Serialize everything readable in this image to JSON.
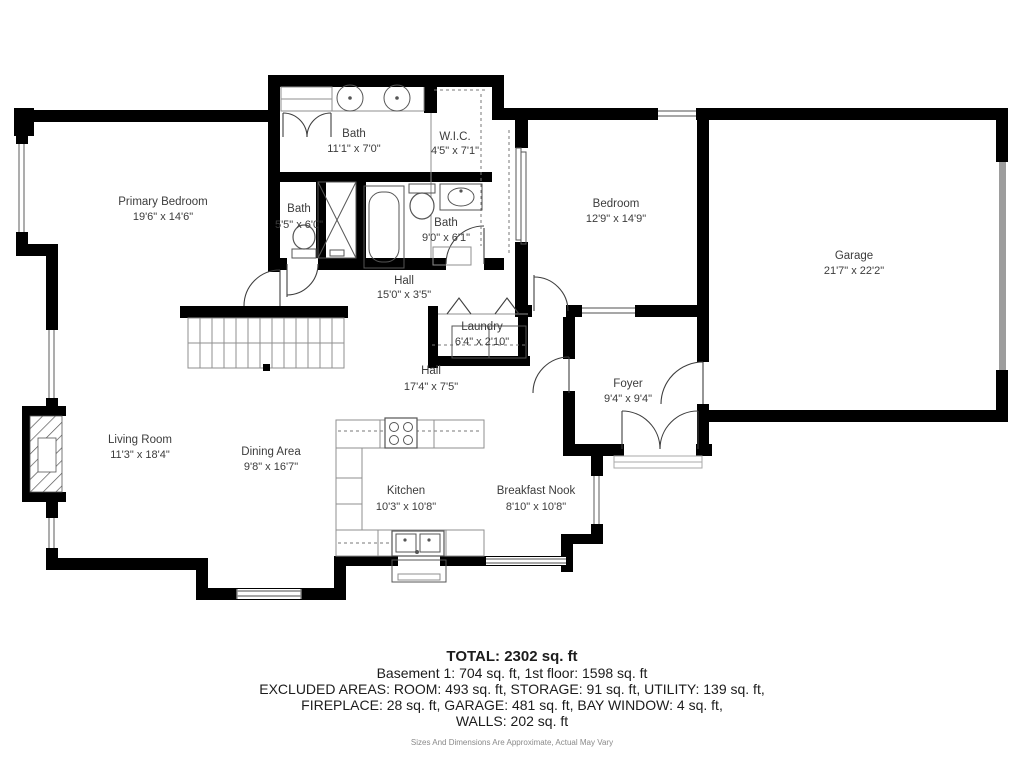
{
  "rooms": {
    "primary_bedroom": {
      "name": "Primary Bedroom",
      "dims": "19'6\" x 14'6\""
    },
    "bath_primary": {
      "name": "Bath",
      "dims": "11'1\" x 7'0\""
    },
    "wic": {
      "name": "W.I.C.",
      "dims": "4'5\" x 7'1\""
    },
    "bath_small": {
      "name": "Bath",
      "dims": "5'5\" x 6'0\""
    },
    "bath_hall": {
      "name": "Bath",
      "dims": "9'0\" x 6'1\""
    },
    "bedroom": {
      "name": "Bedroom",
      "dims": "12'9\" x 14'9\""
    },
    "garage": {
      "name": "Garage",
      "dims": "21'7\" x 22'2\""
    },
    "hall_upper": {
      "name": "Hall",
      "dims": "15'0\" x 3'5\""
    },
    "laundry": {
      "name": "Laundry",
      "dims": "6'4\" x 2'10\""
    },
    "hall_lower": {
      "name": "Hall",
      "dims": "17'4\" x 7'5\""
    },
    "foyer": {
      "name": "Foyer",
      "dims": "9'4\" x 9'4\""
    },
    "living_room": {
      "name": "Living Room",
      "dims": "11'3\" x 18'4\""
    },
    "dining_area": {
      "name": "Dining Area",
      "dims": "9'8\" x 16'7\""
    },
    "kitchen": {
      "name": "Kitchen",
      "dims": "10'3\" x 10'8\""
    },
    "breakfast_nook": {
      "name": "Breakfast Nook",
      "dims": "8'10\" x 10'8\""
    }
  },
  "summary": {
    "total": "TOTAL: 2302 sq. ft",
    "floors": "Basement 1: 704 sq. ft, 1st floor: 1598 sq. ft",
    "excluded_1": "EXCLUDED AREAS: ROOM: 493 sq. ft, STORAGE: 91 sq. ft, UTILITY: 139 sq. ft,",
    "excluded_2": "FIREPLACE: 28 sq. ft, GARAGE: 481 sq. ft, BAY WINDOW: 4 sq. ft,",
    "excluded_3": "WALLS: 202 sq. ft",
    "disclaimer": "Sizes And Dimensions Are Approximate, Actual May Vary"
  },
  "colors": {
    "wall": "#000000",
    "label": "#3c3c3c",
    "window": "#8a8a8a"
  }
}
